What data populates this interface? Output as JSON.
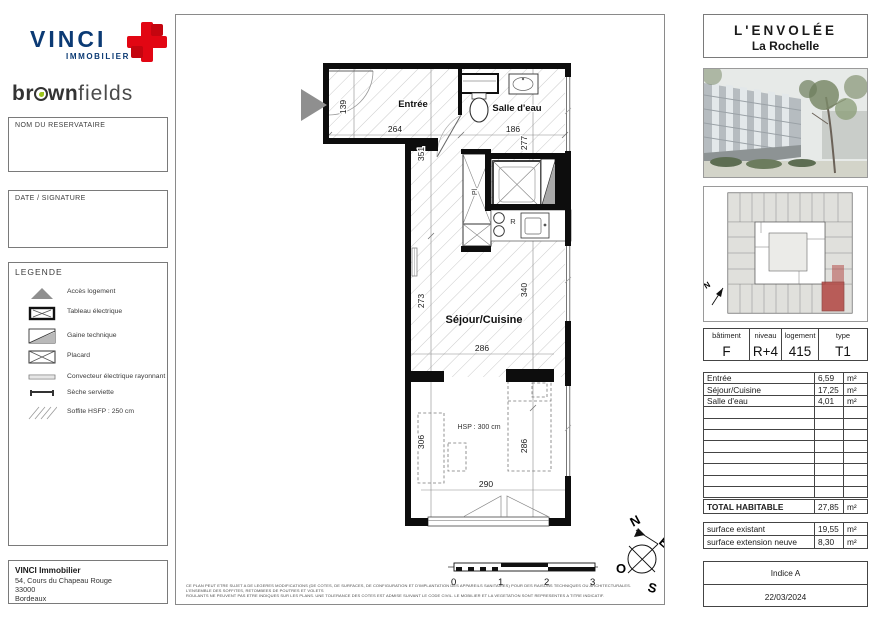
{
  "branding": {
    "vinci": {
      "name": "VINCI",
      "sub": "IMMOBILIER"
    },
    "brownfields": {
      "part1": "br",
      "part2": "wn",
      "part3": "fields"
    }
  },
  "sidebar": {
    "nom_label": "NOM DU RESERVATAIRE",
    "date_label": "DATE / SIGNATURE",
    "legend": {
      "title": "LEGENDE",
      "items": [
        {
          "icon": "acces-logement-icon",
          "label": "Accès logement"
        },
        {
          "icon": "tableau-electrique-icon",
          "label": "Tableau électrique"
        },
        {
          "icon": "gaine-technique-icon",
          "label": "Gaine technique"
        },
        {
          "icon": "placard-icon",
          "label": "Placard"
        },
        {
          "icon": "convecteur-icon",
          "label": "Convecteur électrique rayonnant"
        },
        {
          "icon": "seche-serviette-icon",
          "label": "Sèche serviette"
        },
        {
          "icon": "soffite-icon",
          "label": "Soffite HSFP : 250 cm"
        }
      ]
    },
    "company": {
      "name": "VINCI Immobilier",
      "address": "54, Cours du Chapeau Rouge",
      "postcode": "33000",
      "city": "Bordeaux"
    }
  },
  "plan": {
    "rooms": {
      "entree": "Entrée",
      "salle_deau": "Salle d'eau",
      "sejour_cuisine": "Séjour/Cuisine"
    },
    "annotations": {
      "hsp": "HSP : 300 cm",
      "placard": "Pl",
      "repere": "R"
    },
    "dims": {
      "d139": "139",
      "d264": "264",
      "d186": "186",
      "d277": "277",
      "d351": "351",
      "d273": "273",
      "d340": "340",
      "d286_sejour": "286",
      "d306": "306",
      "d286_chambre": "286",
      "d290": "290"
    }
  },
  "scalebar": {
    "labels": [
      "0",
      "1",
      "2",
      "3"
    ]
  },
  "compass": {
    "n": "N",
    "e": "E",
    "s": "S",
    "o": "O"
  },
  "siteplan": {
    "north": "N"
  },
  "disclaimer": {
    "line1": "CE PLAN PEUT ETRE SUJET A DE LEGERES MODIFICATIONS (DE COTES, DE SURFACES, DE CONFIGURATION ET D'IMPLANTATION DES APPAREILS SANITAIRES) POUR DES RAISONS TECHNIQUES OU ARCHITECTURALES. L'ENSEMBLE DES SOFFITES, RETOMBEES DE POUTRES ET VOLETS",
    "line2": "ROULANTS NE PEUVENT PAS ETRE INDIQUES SUR LES PLANS. UNE TOLERANCE DES COTES EST ADMISE SUIVANT LE CODE CIVIL. LE MOBILIER ET LA VEGETATION SONT REPRESENTES A TITRE INDICATIF."
  },
  "project": {
    "name": "L'ENVOLÉE",
    "city": "La Rochelle"
  },
  "unit_table": {
    "headers": {
      "batiment": "bâtiment",
      "niveau": "niveau",
      "logement": "logement",
      "type": "type"
    },
    "values": {
      "batiment": "F",
      "niveau": "R+4",
      "logement": "415",
      "type": "T1"
    }
  },
  "areas": {
    "rows": [
      {
        "label": "Entrée",
        "value": "6,59",
        "unit": "m²"
      },
      {
        "label": "Séjour/Cuisine",
        "value": "17,25",
        "unit": "m²"
      },
      {
        "label": "Salle d'eau",
        "value": "4,01",
        "unit": "m²"
      }
    ],
    "total": {
      "label": "TOTAL HABITABLE",
      "value": "27,85",
      "unit": "m²"
    },
    "surfaces": [
      {
        "label": "surface existant",
        "value": "19,55",
        "unit": "m²"
      },
      {
        "label": "surface extension neuve",
        "value": "8,30",
        "unit": "m²"
      }
    ]
  },
  "revision": {
    "indice": "Indice A",
    "date": "22/03/2024"
  },
  "colors": {
    "accent_red": "#e20613",
    "vinci_blue": "#0b3a74",
    "brownfields_green": "#9ac31c",
    "highlight_unit": "#b0403c"
  }
}
